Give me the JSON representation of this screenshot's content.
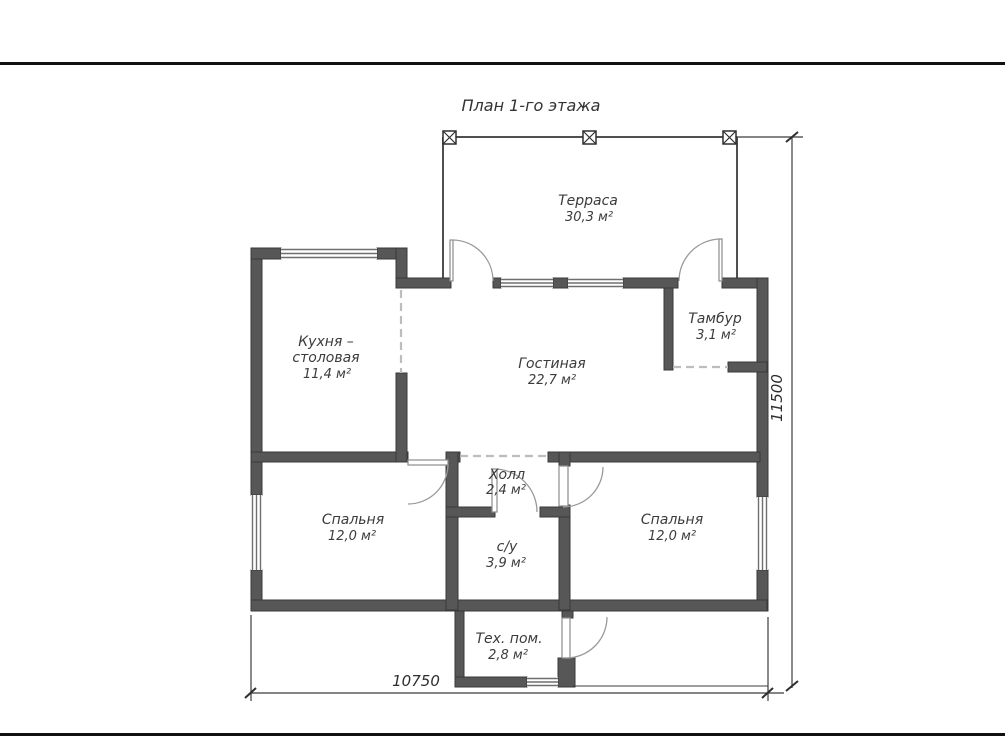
{
  "title": "План 1-го этажа",
  "rooms": {
    "terrace": {
      "line1": "Терраса",
      "area": "30,3 м²"
    },
    "tambour": {
      "line1": "Тамбур",
      "area": "3,1 м²"
    },
    "kitchen": {
      "line1": "Кухня –",
      "line2": "столовая",
      "area": "11,4 м²"
    },
    "living": {
      "line1": "Гостиная",
      "area": "22,7 м²"
    },
    "hall": {
      "line1": "Холл",
      "area": "2,4 м²"
    },
    "bedroom_left": {
      "line1": "Спальня",
      "area": "12,0 м²"
    },
    "bedroom_right": {
      "line1": "Спальня",
      "area": "12,0 м²"
    },
    "bathroom": {
      "line1": "с/у",
      "area": "3,9 м²"
    },
    "tech": {
      "line1": "Тех. пом.",
      "area": "2,8 м²"
    }
  },
  "dimensions": {
    "width_mm": "10750",
    "height_mm": "11500"
  },
  "colors": {
    "wall": "#575757",
    "line": "#3c3c3c",
    "door_arc": "#9a9a9a",
    "dashed_opening": "#bdbdbd",
    "page_rule": "#111111",
    "background": "#ffffff"
  }
}
